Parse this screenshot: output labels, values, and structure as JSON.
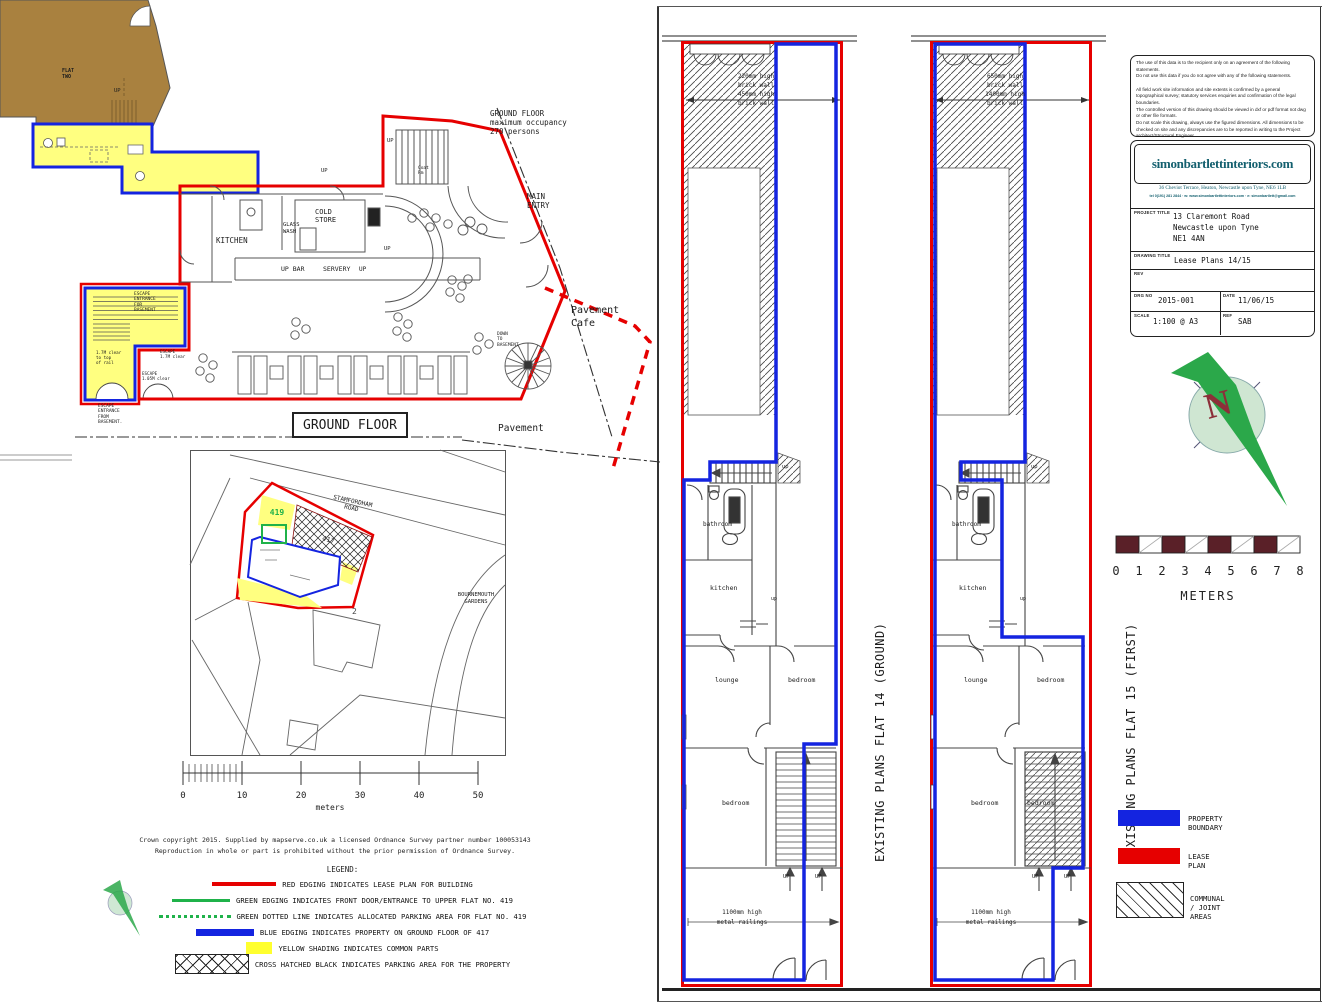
{
  "ground_floor": {
    "box_title": "GROUND FLOOR",
    "occupancy": "GROUND FLOOR\nmaximum occupancy\n270 persons",
    "main_entry": "MAIN\nENTRY",
    "kitchen": "KITCHEN",
    "cold_store": "COLD\nSTORE",
    "glass_wash": "GLASS\nWASH",
    "up_bar": "UP BAR",
    "servery": "SERVERY",
    "up": "UP",
    "coat_rm": "Coat\nRm",
    "down_to_basement": "DOWN\nTO\nBASEMENT",
    "pavement_cafe": "Pavement\nCafe",
    "pavement": "Pavement",
    "flat_two": "FLAT\nTWO",
    "escape_entrance_for_basement": "ESCAPE\nENTRANCE\nFOR\nBASEMENT",
    "clear_note": "1.7M clear\nto top\nof rail",
    "escape_17": "ESCAPE\n1.7M clear",
    "escape_105": "ESCAPE\n1.05M clear",
    "escape_from_basement": "ESCAPE\nENTRANCE\nFROM\nBASEMENT."
  },
  "site_map": {
    "road_1": "STAMFORDHAM\nROAD",
    "road_2": "BOURNEMOUTH\nGARDENS",
    "flat_419": "419",
    "flat_417": "417",
    "building_2": "2"
  },
  "scale_left": {
    "t0": "0",
    "t1": "10",
    "t2": "20",
    "t3": "30",
    "t4": "40",
    "t5": "50",
    "unit": "meters"
  },
  "copyright_line_1": "Crown copyright 2015. Supplied by mapserve.co.uk a licensed Ordnance Survey partner number 100053143",
  "copyright_line_2": "Reproduction in whole or part is prohibited without the prior permission of Ordnance Survey.",
  "legend_left": {
    "title": "LEGEND:",
    "items": [
      {
        "label": "RED EDGING INDICATES LEASE PLAN FOR BUILDING"
      },
      {
        "label": "GREEN EDGING INDICATES FRONT DOOR/ENTRANCE TO UPPER FLAT NO. 419"
      },
      {
        "label": "GREEN DOTTED LINE INDICATES ALLOCATED PARKING AREA FOR FLAT NO. 419"
      },
      {
        "label": "BLUE EDGING INDICATES PROPERTY ON GROUND FLOOR OF 417"
      },
      {
        "label": "YELLOW SHADING INDICATES COMMON PARTS"
      },
      {
        "label": "CROSS HATCHED BLACK INDICATES PARKING AREA FOR THE PROPERTY"
      }
    ]
  },
  "flats": {
    "flat14_title": "EXISTING PLANS FLAT 14 (GROUND)",
    "flat15_title": "EXISTING PLANS FLAT 15 (FIRST)",
    "bathroom": "bathroom",
    "kitchen": "kitchen",
    "lounge": "lounge",
    "bedroom": "bedroom",
    "up_small": "up",
    "up": "UP",
    "wall_note_14": "220mm high\nbrick wall\n450mm high\nbrick wall",
    "wall_note_15": "650mm high\nbrick wall\n1400mm high\nbrick wall",
    "railings": "1100mm high\nmetal railings"
  },
  "title_block": {
    "disclaimer": "The use of this data is to the recipient only on an agreement of the following statements.\nDo not use this data if you do not agree with any of the following statements.\n\nAll field work site information and site extents is confirmed by a general topographical survey; statutory services enquiries and confirmation of the legal boundaries.\nThe controlled version of this drawing should be viewed in dxf or pdf format not dwg or other file formats.\nDo not scale this drawing, always use the figured dimensions. All dimensions to be checked on site and any discrepancies are to be reported in writing to the Project architect/Structural Engineer",
    "brand": "simonbartlettinteriors.com",
    "address": "36 Cheviot Terrace, Heaton, Newcastle upon Tyne, NE6 1LB",
    "contact": "tel 0(191) 281 2844 · w: www.simonbartlettinteriors.com · e: simonbartlett@gmail.com",
    "project_title_label": "PROJECT TITLE",
    "project_title": "13 Claremont Road\nNewcastle upon Tyne\nNE1 4AN",
    "drawing_title_label": "DRAWING TITLE",
    "drawing_title": "Lease Plans 14/15",
    "rev_label": "REV",
    "drg_no_label": "DRG NO",
    "drg_no": "2015-001",
    "date_label": "DATE",
    "date": "11/06/15",
    "scale_label": "SCALE",
    "scale": "1:100 @ A3",
    "ref_label": "REF",
    "ref": "SAB"
  },
  "north_letter": "N",
  "scale_right": {
    "t0": "0",
    "t1": "1",
    "t2": "2",
    "t3": "3",
    "t4": "4",
    "t5": "5",
    "t6": "6",
    "t7": "7",
    "t8": "8",
    "unit": "METERS"
  },
  "legend_right": {
    "items": [
      {
        "label": "PROPERTY BOUNDARY"
      },
      {
        "label": "LEASE PLAN"
      },
      {
        "label": "COMMUNAL / JOINT AREAS"
      }
    ]
  },
  "colors": {
    "lease_red": "#e60000",
    "boundary_blue": "#1424e0",
    "common_yellow": "#ffff80",
    "entrance_green": "#1fb24a",
    "adjacent_brown": "#a9813f",
    "scale_maroon": "#5a2028",
    "brand_teal": "#14606f"
  }
}
